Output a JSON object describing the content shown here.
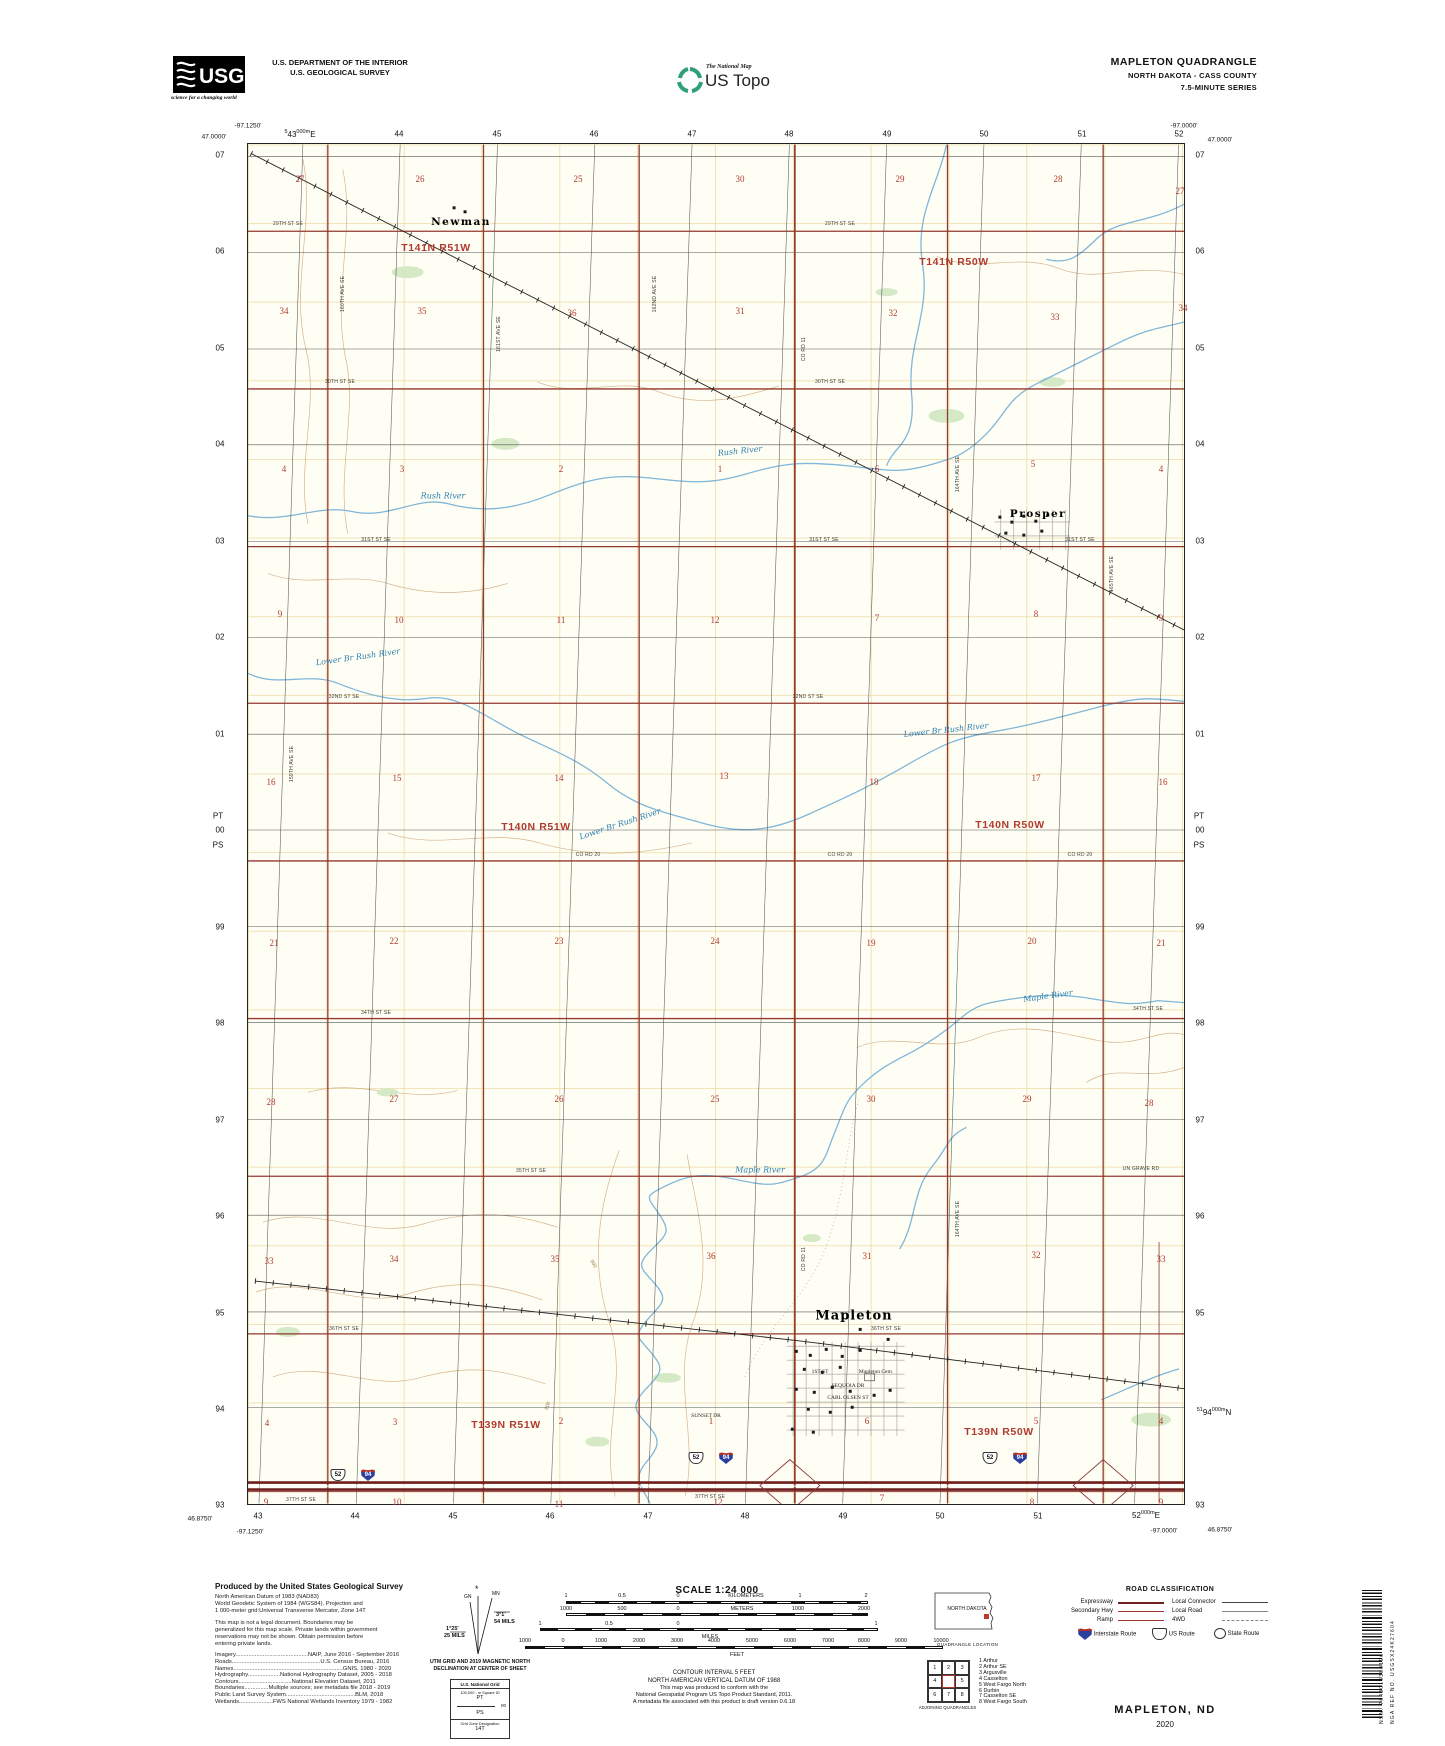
{
  "colors": {
    "paper": "#fffef4",
    "road_red": "#93392f",
    "expressway": "#6f1f1f",
    "water": "#7fb6d9",
    "contour": "#cfa87b",
    "section_red": "#b03a2e",
    "vegetation": "#d5e9c6",
    "interstate_shield": "#2b3f9e",
    "railroad": "#222222"
  },
  "header": {
    "agency_line1": "U.S. DEPARTMENT OF THE INTERIOR",
    "agency_line2": "U.S. GEOLOGICAL SURVEY",
    "usgs_logo": "USGS",
    "usgs_tagline": "science for a changing world",
    "natmap_line1": "The National Map",
    "natmap_line2": "US Topo",
    "quad_title": "MAPLETON QUADRANGLE",
    "quad_sub1": "NORTH DAKOTA - CASS COUNTY",
    "quad_sub2": "7.5-MINUTE SERIES"
  },
  "map": {
    "labels": [
      [
        "Newman",
        213,
        78,
        "town"
      ],
      [
        "Prosper",
        790,
        370,
        "town"
      ],
      [
        "Mapleton",
        606,
        1172,
        "townb"
      ],
      [
        "T141N R51W",
        188,
        104,
        "twp"
      ],
      [
        "T141N R50W",
        706,
        118,
        "twp"
      ],
      [
        "T140N R51W",
        288,
        683,
        "twp"
      ],
      [
        "T140N R50W",
        762,
        681,
        "twp"
      ],
      [
        "T139N R51W",
        258,
        1281,
        "twp"
      ],
      [
        "T139N R50W",
        751,
        1288,
        "twp"
      ],
      [
        "27",
        52,
        35,
        "sec"
      ],
      [
        "26",
        172,
        35,
        "sec"
      ],
      [
        "25",
        330,
        35,
        "sec"
      ],
      [
        "30",
        492,
        35,
        "sec"
      ],
      [
        "29",
        652,
        35,
        "sec"
      ],
      [
        "28",
        810,
        35,
        "sec"
      ],
      [
        "27",
        932,
        47,
        "sec"
      ],
      [
        "34",
        36,
        167,
        "sec"
      ],
      [
        "35",
        174,
        167,
        "sec"
      ],
      [
        "36",
        324,
        169,
        "sec"
      ],
      [
        "31",
        492,
        167,
        "sec"
      ],
      [
        "32",
        645,
        169,
        "sec"
      ],
      [
        "33",
        807,
        173,
        "sec"
      ],
      [
        "34",
        935,
        164,
        "sec"
      ],
      [
        "4",
        36,
        325,
        "sec"
      ],
      [
        "3",
        154,
        325,
        "sec"
      ],
      [
        "2",
        313,
        325,
        "sec"
      ],
      [
        "1",
        472,
        325,
        "sec"
      ],
      [
        "6",
        629,
        325,
        "sec"
      ],
      [
        "5",
        785,
        320,
        "sec"
      ],
      [
        "4",
        913,
        325,
        "sec"
      ],
      [
        "9",
        32,
        470,
        "sec"
      ],
      [
        "10",
        151,
        476,
        "sec"
      ],
      [
        "11",
        313,
        476,
        "sec"
      ],
      [
        "12",
        467,
        476,
        "sec"
      ],
      [
        "7",
        629,
        474,
        "sec"
      ],
      [
        "8",
        788,
        470,
        "sec"
      ],
      [
        "9",
        913,
        474,
        "sec"
      ],
      [
        "16",
        23,
        638,
        "sec"
      ],
      [
        "15",
        149,
        634,
        "sec"
      ],
      [
        "14",
        311,
        634,
        "sec"
      ],
      [
        "13",
        476,
        632,
        "sec"
      ],
      [
        "18",
        626,
        638,
        "sec"
      ],
      [
        "17",
        788,
        634,
        "sec"
      ],
      [
        "16",
        915,
        638,
        "sec"
      ],
      [
        "21",
        26,
        799,
        "sec"
      ],
      [
        "22",
        146,
        797,
        "sec"
      ],
      [
        "23",
        311,
        797,
        "sec"
      ],
      [
        "24",
        467,
        797,
        "sec"
      ],
      [
        "19",
        623,
        799,
        "sec"
      ],
      [
        "20",
        784,
        797,
        "sec"
      ],
      [
        "21",
        913,
        799,
        "sec"
      ],
      [
        "28",
        23,
        958,
        "sec"
      ],
      [
        "27",
        146,
        955,
        "sec"
      ],
      [
        "26",
        311,
        955,
        "sec"
      ],
      [
        "25",
        467,
        955,
        "sec"
      ],
      [
        "30",
        623,
        955,
        "sec"
      ],
      [
        "29",
        779,
        955,
        "sec"
      ],
      [
        "28",
        901,
        959,
        "sec"
      ],
      [
        "33",
        21,
        1117,
        "sec"
      ],
      [
        "34",
        146,
        1115,
        "sec"
      ],
      [
        "35",
        307,
        1115,
        "sec"
      ],
      [
        "36",
        463,
        1112,
        "sec"
      ],
      [
        "31",
        619,
        1112,
        "sec"
      ],
      [
        "32",
        788,
        1111,
        "sec"
      ],
      [
        "33",
        913,
        1115,
        "sec"
      ],
      [
        "4",
        19,
        1279,
        "sec"
      ],
      [
        "3",
        147,
        1278,
        "sec"
      ],
      [
        "2",
        313,
        1277,
        "sec"
      ],
      [
        "1",
        463,
        1277,
        "sec"
      ],
      [
        "6",
        619,
        1277,
        "sec"
      ],
      [
        "5",
        788,
        1277,
        "sec"
      ],
      [
        "4",
        913,
        1277,
        "sec"
      ],
      [
        "9",
        18,
        1358,
        "sec"
      ],
      [
        "10",
        149,
        1358,
        "sec"
      ],
      [
        "11",
        311,
        1360,
        "sec"
      ],
      [
        "12",
        470,
        1358,
        "sec"
      ],
      [
        "7",
        634,
        1354,
        "sec"
      ],
      [
        "8",
        784,
        1358,
        "sec"
      ],
      [
        "9",
        913,
        1358,
        "sec"
      ],
      [
        "Rush River",
        195,
        352,
        "riv"
      ],
      [
        "Rush River",
        492,
        307,
        "riv",
        -6
      ],
      [
        "Lower Br Rush River",
        110,
        513,
        "riv",
        -8
      ],
      [
        "Lower Br Rush River",
        372,
        680,
        "riv",
        -18
      ],
      [
        "Lower Br Rush River",
        698,
        586,
        "riv",
        -6
      ],
      [
        "Maple River",
        512,
        1026,
        "riv"
      ],
      [
        "Maple River",
        800,
        852,
        "riv",
        -8
      ],
      [
        "29TH ST SE",
        40,
        80,
        "rd"
      ],
      [
        "29TH ST SE",
        592,
        80,
        "rd"
      ],
      [
        "30TH ST SE",
        92,
        238,
        "rd"
      ],
      [
        "30TH ST SE",
        582,
        238,
        "rd"
      ],
      [
        "31ST ST SE",
        128,
        396,
        "rd"
      ],
      [
        "31ST ST SE",
        576,
        396,
        "rd"
      ],
      [
        "31ST ST SE",
        832,
        396,
        "rd"
      ],
      [
        "32ND ST SE",
        96,
        553,
        "rd"
      ],
      [
        "32ND ST SE",
        560,
        553,
        "rd"
      ],
      [
        "CO RD 20",
        340,
        711,
        "rd"
      ],
      [
        "CO RD 20",
        592,
        711,
        "rd"
      ],
      [
        "CO RD 20",
        832,
        711,
        "rd"
      ],
      [
        "34TH ST SE",
        128,
        869,
        "rd"
      ],
      [
        "34TH ST SE",
        900,
        865,
        "rd"
      ],
      [
        "35TH ST SE",
        283,
        1027,
        "rd"
      ],
      [
        "UN GRAVE RD",
        893,
        1025,
        "rd"
      ],
      [
        "36TH ST SE",
        96,
        1185,
        "rd"
      ],
      [
        "36TH ST SE",
        638,
        1185,
        "rd"
      ],
      [
        "37TH ST SE",
        53,
        1356,
        "rd"
      ],
      [
        "37TH ST SE",
        462,
        1353,
        "rd"
      ],
      [
        "160TH AVE SE",
        95,
        150,
        "rdv",
        -90
      ],
      [
        "161ST AVE SE",
        251,
        190,
        "rdv",
        -90
      ],
      [
        "162ND AVE SE",
        407,
        150,
        "rdv",
        -90
      ],
      [
        "CO RD 11",
        556,
        205,
        "rdv",
        -90
      ],
      [
        "CO RD 11",
        556,
        1115,
        "rdv",
        -90
      ],
      [
        "164TH AVE SE",
        710,
        330,
        "rdv",
        -90
      ],
      [
        "164TH AVE SE",
        710,
        1075,
        "rdv",
        -90
      ],
      [
        "165TH AVE SE",
        864,
        430,
        "rdv",
        -90
      ],
      [
        "159TH AVE SE",
        44,
        620,
        "rdv",
        -90
      ],
      [
        "1ST ST",
        572,
        1228,
        "cem"
      ],
      [
        "Mapleton Cem.",
        628,
        1228,
        "cem"
      ],
      [
        "SEQUOIA DR",
        600,
        1242,
        "cem"
      ],
      [
        "CARL OLSEN ST",
        600,
        1254,
        "cem"
      ],
      [
        "SUNSET DR",
        458,
        1272,
        "cem"
      ],
      [
        "900",
        300,
        1262,
        "cont",
        -70
      ],
      [
        "900",
        345,
        1120,
        "cont",
        60
      ],
      [
        "52",
        90,
        1331,
        "shus"
      ],
      [
        "94",
        120,
        1331,
        "shint"
      ],
      [
        "52",
        448,
        1314,
        "shus"
      ],
      [
        "94",
        478,
        1314,
        "shint"
      ],
      [
        "52",
        742,
        1314,
        "shus"
      ],
      [
        "94",
        772,
        1314,
        "shint"
      ]
    ]
  },
  "page_labels": [
    [
      "-97.1250'",
      248,
      126,
      "coord"
    ],
    [
      "47.0000'",
      214,
      137,
      "coord"
    ],
    [
      "-97.0000'",
      1184,
      126,
      "coord"
    ],
    [
      "47.0000'",
      1220,
      140,
      "coord"
    ],
    [
      "46.8750'",
      200,
      1519,
      "coord"
    ],
    [
      "-97.1250'",
      250,
      1532,
      "coord"
    ],
    [
      "-97.0000'",
      1164,
      1531,
      "coord"
    ],
    [
      "46.8750'",
      1220,
      1530,
      "coord"
    ],
    [
      "5|43|000m|E",
      300,
      134,
      "utm"
    ],
    [
      "44",
      399,
      134,
      "tick"
    ],
    [
      "45",
      497,
      134,
      "tick"
    ],
    [
      "46",
      594,
      134,
      "tick"
    ],
    [
      "47",
      692,
      134,
      "tick"
    ],
    [
      "48",
      789,
      134,
      "tick"
    ],
    [
      "49",
      887,
      134,
      "tick"
    ],
    [
      "50",
      984,
      134,
      "tick"
    ],
    [
      "51",
      1082,
      134,
      "tick"
    ],
    [
      "52",
      1179,
      134,
      "tick"
    ],
    [
      "43",
      258,
      1516,
      "tick"
    ],
    [
      "44",
      355,
      1516,
      "tick"
    ],
    [
      "45",
      453,
      1516,
      "tick"
    ],
    [
      "46",
      550,
      1516,
      "tick"
    ],
    [
      "47",
      648,
      1516,
      "tick"
    ],
    [
      "48",
      745,
      1516,
      "tick"
    ],
    [
      "49",
      843,
      1516,
      "tick"
    ],
    [
      "50",
      940,
      1516,
      "tick"
    ],
    [
      "51",
      1038,
      1516,
      "tick"
    ],
    [
      "|52|000m|E",
      1146,
      1515,
      "utm"
    ],
    [
      "07",
      220,
      155,
      "tick"
    ],
    [
      "06",
      220,
      251,
      "tick"
    ],
    [
      "05",
      220,
      348,
      "tick"
    ],
    [
      "04",
      220,
      444,
      "tick"
    ],
    [
      "03",
      220,
      541,
      "tick"
    ],
    [
      "02",
      220,
      637,
      "tick"
    ],
    [
      "01",
      220,
      734,
      "tick"
    ],
    [
      "PT",
      218,
      816,
      "tick"
    ],
    [
      "00",
      220,
      830,
      "tick"
    ],
    [
      "PS",
      218,
      845,
      "tick"
    ],
    [
      "99",
      220,
      927,
      "tick"
    ],
    [
      "98",
      220,
      1023,
      "tick"
    ],
    [
      "97",
      220,
      1120,
      "tick"
    ],
    [
      "96",
      220,
      1216,
      "tick"
    ],
    [
      "95",
      220,
      1313,
      "tick"
    ],
    [
      "94",
      220,
      1409,
      "tick"
    ],
    [
      "93",
      220,
      1505,
      "tick"
    ],
    [
      "07",
      1200,
      155,
      "tick"
    ],
    [
      "06",
      1200,
      251,
      "tick"
    ],
    [
      "05",
      1200,
      348,
      "tick"
    ],
    [
      "04",
      1200,
      444,
      "tick"
    ],
    [
      "03",
      1200,
      541,
      "tick"
    ],
    [
      "02",
      1200,
      637,
      "tick"
    ],
    [
      "01",
      1200,
      734,
      "tick"
    ],
    [
      "PT",
      1199,
      816,
      "tick"
    ],
    [
      "00",
      1200,
      830,
      "tick"
    ],
    [
      "PS",
      1199,
      845,
      "tick"
    ],
    [
      "99",
      1200,
      927,
      "tick"
    ],
    [
      "98",
      1200,
      1023,
      "tick"
    ],
    [
      "97",
      1200,
      1120,
      "tick"
    ],
    [
      "96",
      1200,
      1216,
      "tick"
    ],
    [
      "95",
      1200,
      1313,
      "tick"
    ],
    [
      "51|94|000m|N",
      1214,
      1412,
      "utm"
    ],
    [
      "93",
      1200,
      1505,
      "tick"
    ],
    [
      "1",
      566,
      1596,
      "scl"
    ],
    [
      "0.5",
      622,
      1596,
      "scl"
    ],
    [
      "0",
      678,
      1596,
      "scl"
    ],
    [
      "KILOMETERS",
      746,
      1596,
      "scl"
    ],
    [
      "1",
      800,
      1596,
      "scl"
    ],
    [
      "2",
      866,
      1596,
      "scl"
    ],
    [
      "1000",
      566,
      1609,
      "scl"
    ],
    [
      "500",
      622,
      1609,
      "scl"
    ],
    [
      "0",
      678,
      1609,
      "scl"
    ],
    [
      "METERS",
      742,
      1609,
      "scl"
    ],
    [
      "1000",
      798,
      1609,
      "scl"
    ],
    [
      "2000",
      864,
      1609,
      "scl"
    ],
    [
      "1",
      540,
      1624,
      "scl"
    ],
    [
      "0.5",
      609,
      1624,
      "scl"
    ],
    [
      "0",
      678,
      1624,
      "scl"
    ],
    [
      "1",
      876,
      1624,
      "scl"
    ],
    [
      "MILES",
      710,
      1637,
      "scl"
    ],
    [
      "1000",
      525,
      1641,
      "scl"
    ],
    [
      "0",
      563,
      1641,
      "scl"
    ],
    [
      "1000",
      601,
      1641,
      "scl"
    ],
    [
      "2000",
      639,
      1641,
      "scl"
    ],
    [
      "3000",
      677,
      1641,
      "scl"
    ],
    [
      "4000",
      714,
      1641,
      "scl"
    ],
    [
      "5000",
      752,
      1641,
      "scl"
    ],
    [
      "6000",
      790,
      1641,
      "scl"
    ],
    [
      "7000",
      828,
      1641,
      "scl"
    ],
    [
      "8000",
      864,
      1641,
      "scl"
    ],
    [
      "9000",
      901,
      1641,
      "scl"
    ],
    [
      "10000",
      941,
      1641,
      "scl"
    ],
    [
      "FEET",
      737,
      1655,
      "scl"
    ]
  ],
  "footer": {
    "produced_title": "Produced by the United States Geological Survey",
    "produced_lines": [
      "North American Datum of 1983 (NAD83)",
      "World Geodetic System of 1984 (WGS84).  Projection and",
      "1 000-meter grid:Universal Transverse Mercator, Zone 14T",
      "",
      "This map is not a legal document. Boundaries may be",
      "generalized for this map scale. Private lands within government",
      "reservations may not be shown. Obtain permission before",
      "entering private lands."
    ],
    "sources": [
      "Imagery.............................................NAIP, June 2016 - September 2016",
      "Roads.......................................................U.S. Census Bureau, 2016",
      "Names....................................................................GNIS, 1980 - 2020",
      "Hydrography....................National Hydrography Dataset, 2005 - 2018",
      "Contours.................................National Elevation Dataset, 2011",
      "Boundaries...............Multiple sources; see metadata file 2018 - 2019",
      "Public Land Survey System...........................................BLM, 2018",
      "Wetlands.....................FWS National Wetlands Inventory 1979 - 1982"
    ],
    "declination": {
      "star": "*",
      "mn": "MN",
      "gn": "GN",
      "mn_deg": "3°1'",
      "mn_mils": "54 MILS",
      "gn_deg": "1°25'",
      "gn_mils": "25 MILS",
      "caption1": "UTM GRID AND 2019 MAGNETIC NORTH",
      "caption2": "DECLINATION AT CENTER OF SHEET"
    },
    "usng": {
      "title": "U.S. National Grid",
      "sub": "100,000 - m Square ID",
      "sq_top": "PT",
      "mid_val": "00",
      "sq_bottom": "PS",
      "zone_label": "Grid Zone Designation",
      "zone": "14T"
    },
    "scale_title": "SCALE 1:24 000",
    "center_notes": [
      "CONTOUR INTERVAL 5 FEET",
      "NORTH AMERICAN VERTICAL DATUM OF 1988",
      "",
      "This map was produced to conform with the",
      "National Geospatial Program US Topo Product Standard, 2011.",
      "A metadata file associated with this product is draft version 0.6.18"
    ],
    "quad_location": {
      "state": "NORTH DAKOTA",
      "caption": "QUADRANGLE LOCATION"
    },
    "adjoining": {
      "cells": [
        "1",
        "2",
        "3",
        "4",
        "",
        "5",
        "6",
        "7",
        "8"
      ],
      "names": [
        "1 Arthur",
        "2 Arthur SE",
        "3 Argusville",
        "4 Casselton",
        "5 West Fargo North",
        "6 Durbin",
        "7 Casselton SE",
        "8 West Fargo South"
      ],
      "caption": "ADJOINING QUADRANGLES"
    },
    "road_class": {
      "title": "ROAD CLASSIFICATION",
      "expressway": "Expressway",
      "secondary": "Secondary Hwy",
      "ramp": "Ramp",
      "connector": "Local Connector",
      "local": "Local Road",
      "fourwd": "4WD",
      "interstate": "Interstate Route",
      "us_route": "US Route",
      "state_route": "State Route",
      "interstate_shield_num": "94",
      "us_shield": "",
      "state_shield": ""
    },
    "title_block": {
      "name": "MAPLETON, ND",
      "year": "2020"
    },
    "barcode": {
      "nsn": "NSN. 7643016380196",
      "nga": "NGA REF NO. USGSX24K27604"
    }
  }
}
